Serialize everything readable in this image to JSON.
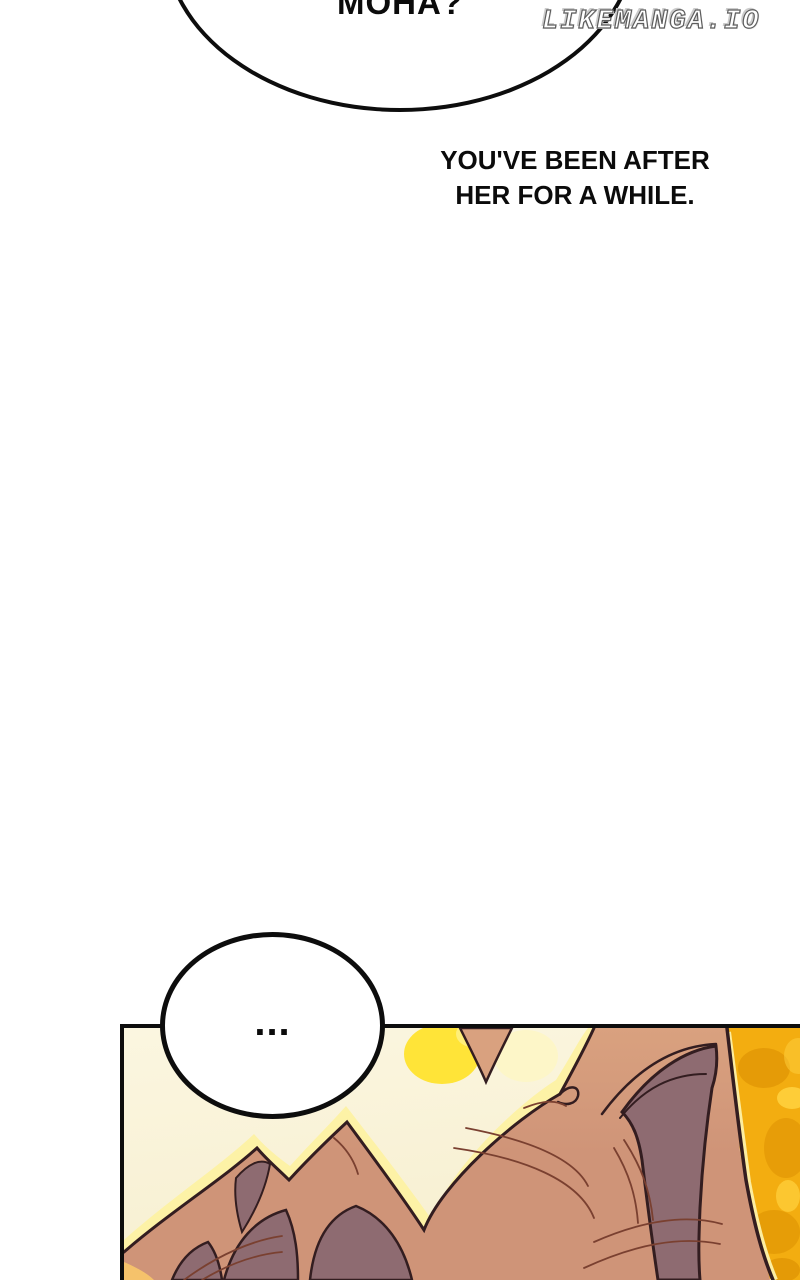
{
  "watermark": {
    "text": "LIKEMANGA.IO"
  },
  "speech": {
    "top_bubble": {
      "text": "MOHA?"
    },
    "narration": {
      "line1": "YOU'VE BEEN AFTER",
      "line2": "HER FOR A WHILE."
    },
    "ellipsis_bubble": {
      "text": "..."
    }
  },
  "panel": {
    "artwork": "hair-closeup-artwork"
  },
  "colors": {
    "ink": "#0d0d0d",
    "cream_bg": "#fbf6e0",
    "cream_deep": "#f7efd0",
    "hair_tan": "#cf9478",
    "hair_tan_light": "#d9a17f",
    "hair_shadow": "#8e6b71",
    "hair_outline": "#331d20",
    "hair_line": "#7a4030",
    "gold_bg": "#f3ad10",
    "gold_dark": "#e09504",
    "gold_light": "#ffd23f",
    "highlight_yellow": "#ffe438",
    "pale_highlight": "#fdf2a6",
    "rim_light": "#fceda0",
    "corner_orange": "#f5c26b"
  }
}
